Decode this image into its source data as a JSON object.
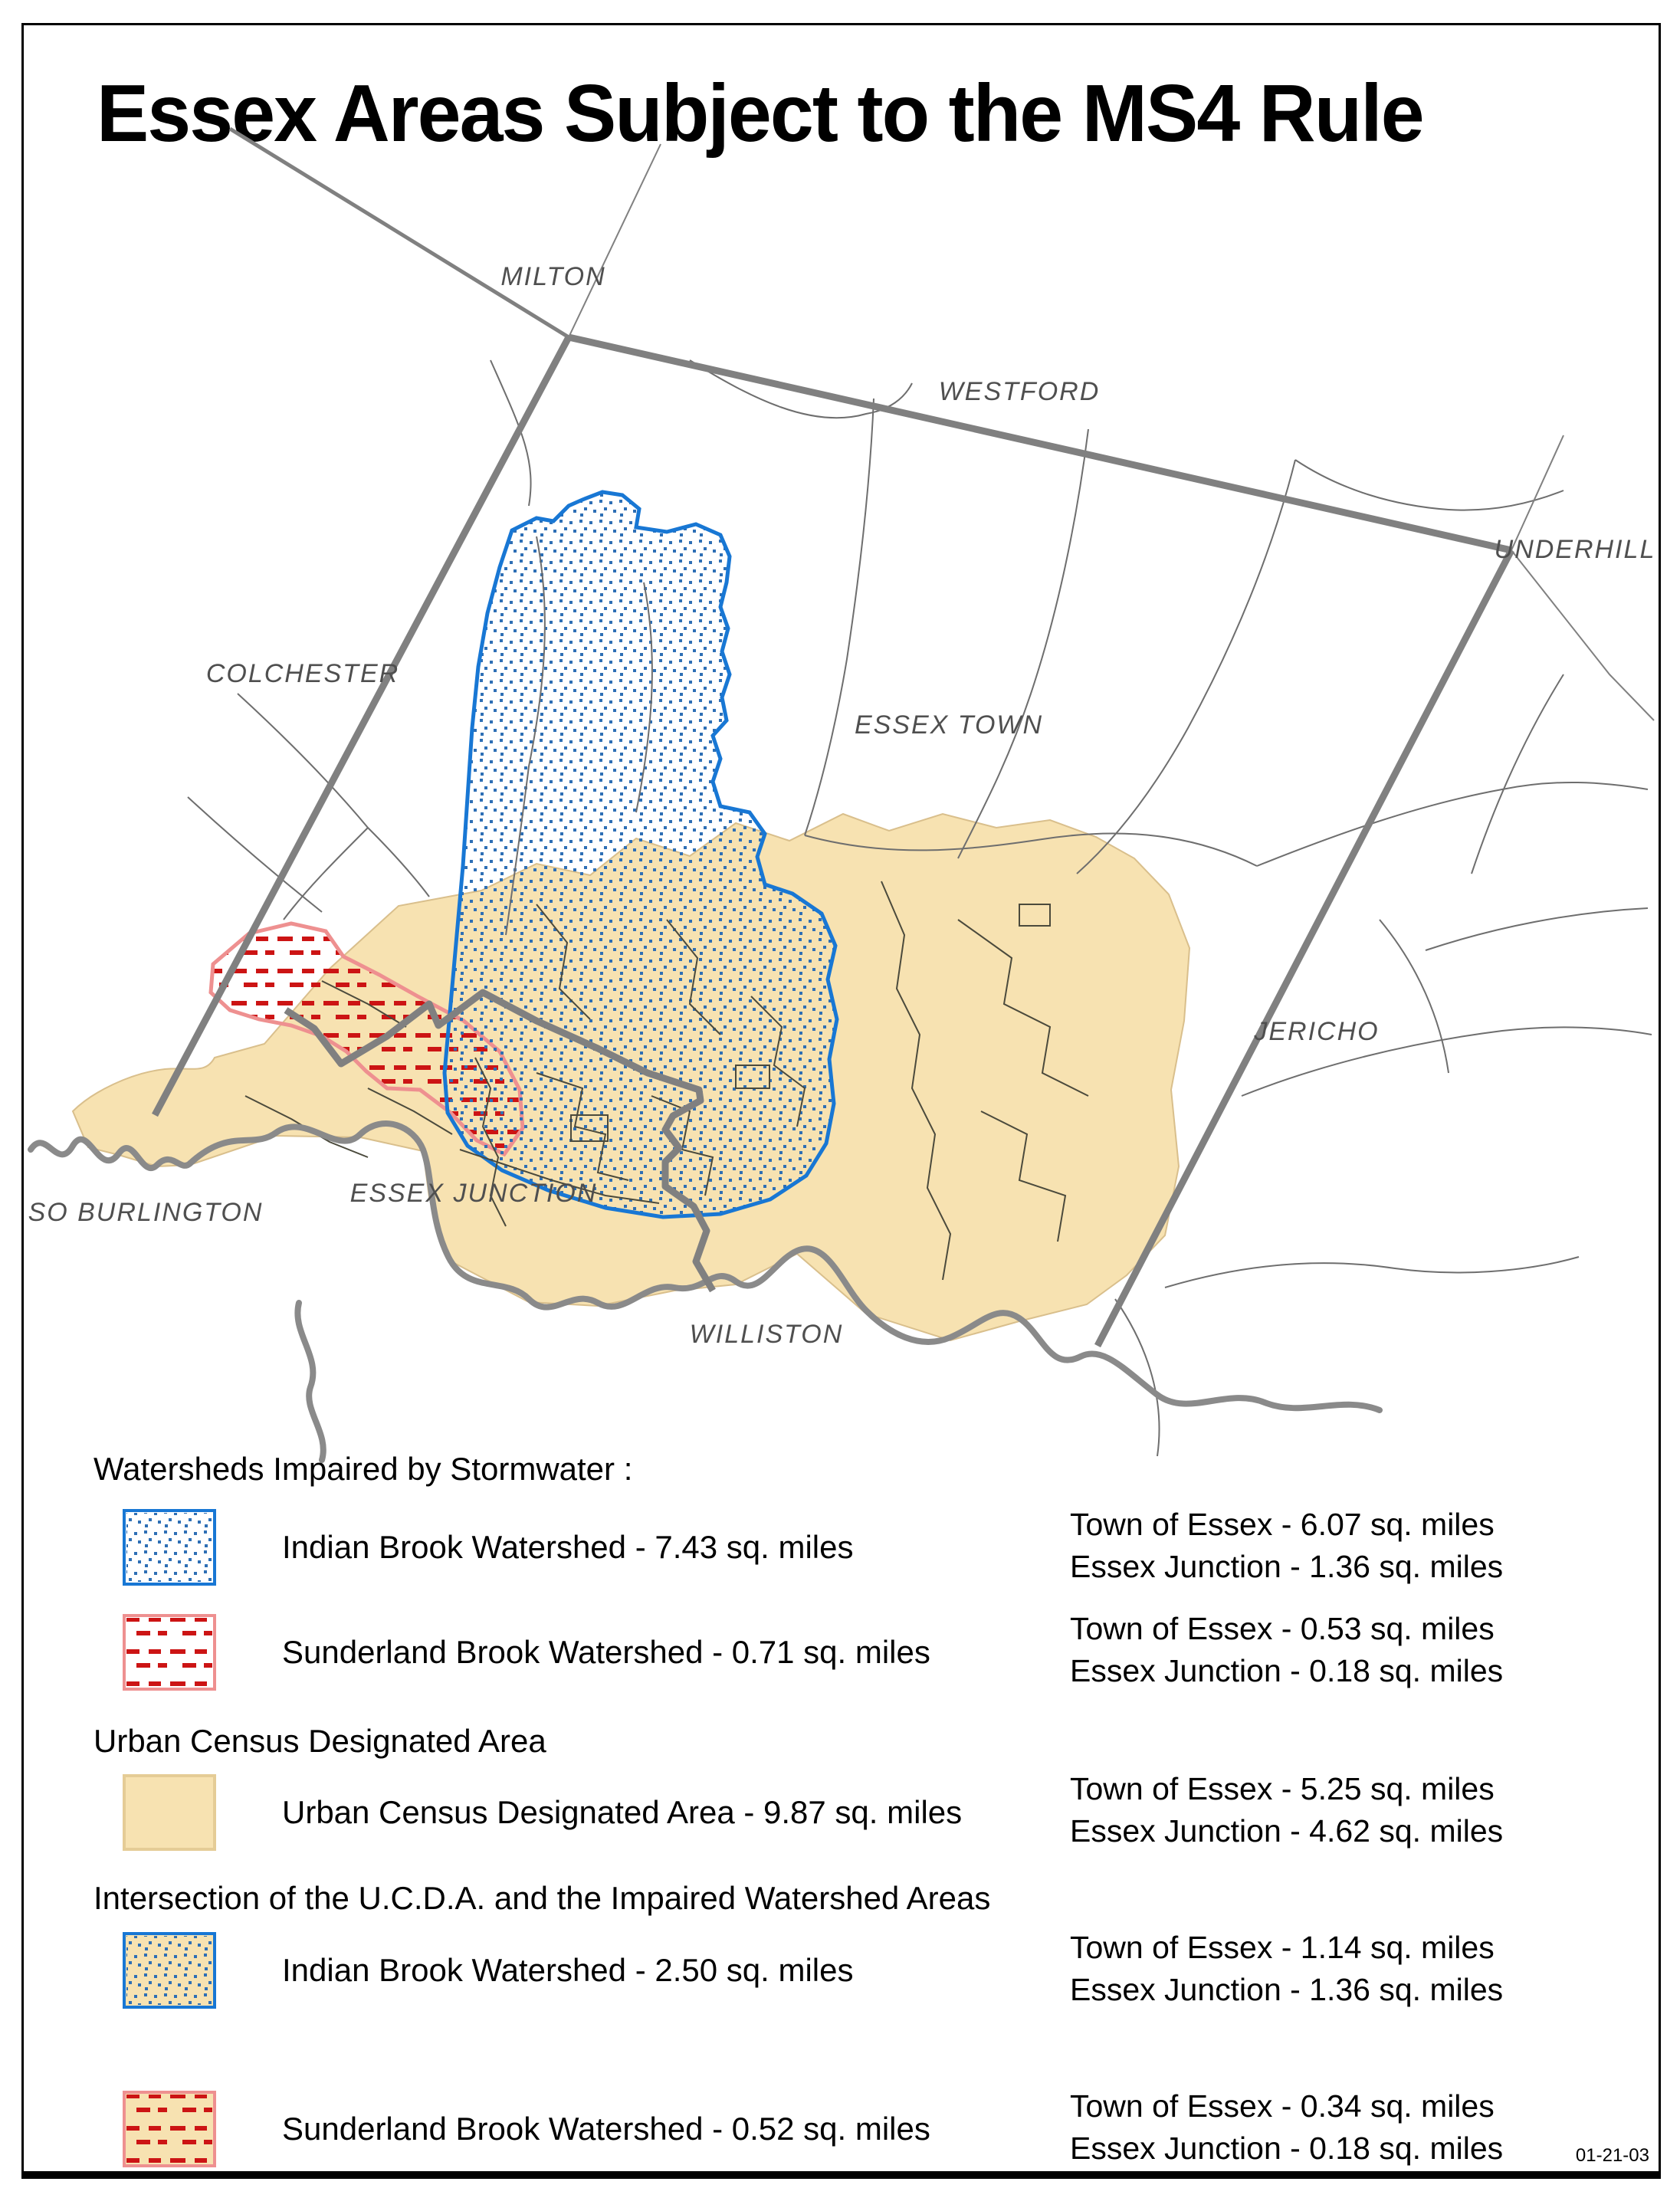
{
  "title": "Essex Areas Subject to the MS4 Rule",
  "date_stamp": "01-21-03",
  "map": {
    "labels": [
      {
        "text": "MILTON"
      },
      {
        "text": "WESTFORD"
      },
      {
        "text": "UNDERHILL"
      },
      {
        "text": "COLCHESTER"
      },
      {
        "text": "ESSEX TOWN"
      },
      {
        "text": "JERICHO"
      },
      {
        "text": "SO BURLINGTON"
      },
      {
        "text": "ESSEX JUNCTION"
      },
      {
        "text": "WILLISTON"
      }
    ],
    "regions": [
      {
        "name": "Indian Brook Watershed",
        "style": "blue-dots"
      },
      {
        "name": "Sunderland Brook Watershed",
        "style": "red-dashes"
      },
      {
        "name": "Urban Census Designated Area",
        "style": "tan-fill"
      }
    ]
  },
  "legend": {
    "sections": [
      {
        "heading": "Watersheds Impaired by Stormwater :",
        "items": [
          {
            "label": "Indian Brook Watershed - 7.43 sq. miles",
            "swatch": "blue-dots-on-white",
            "stats": [
              "Town of Essex - 6.07 sq. miles",
              "Essex Junction - 1.36 sq. miles"
            ]
          },
          {
            "label": "Sunderland Brook Watershed - 0.71 sq. miles",
            "swatch": "red-dashes-on-white",
            "stats": [
              "Town of Essex - 0.53 sq. miles",
              "Essex Junction - 0.18 sq. miles"
            ]
          }
        ]
      },
      {
        "heading": "Urban Census Designated Area",
        "items": [
          {
            "label": "Urban Census Designated Area - 9.87 sq. miles",
            "swatch": "tan",
            "stats": [
              "Town of Essex - 5.25 sq. miles",
              "Essex Junction - 4.62 sq. miles"
            ]
          }
        ]
      },
      {
        "heading": "Intersection of the U.C.D.A. and the Impaired Watershed Areas",
        "items": [
          {
            "label": "Indian Brook Watershed - 2.50 sq. miles",
            "swatch": "blue-dots-on-tan",
            "stats": [
              "Town of Essex - 1.14 sq. miles",
              "Essex Junction - 1.36 sq. miles"
            ]
          },
          {
            "label": "Sunderland Brook Watershed - 0.52 sq. miles",
            "swatch": "red-dashes-on-tan",
            "stats": [
              "Town of Essex - 0.34 sq. miles",
              "Essex Junction - 0.18 sq. miles"
            ]
          }
        ]
      }
    ]
  },
  "colors": {
    "tan": "#F7E2B1",
    "tan_border": "#D9BF8C",
    "blue_outline": "#1877D4",
    "blue_dot": "#2E6FB5",
    "red_dash": "#CC1414",
    "pink_outline": "#EE9090",
    "boundary_gray": "#808080"
  }
}
